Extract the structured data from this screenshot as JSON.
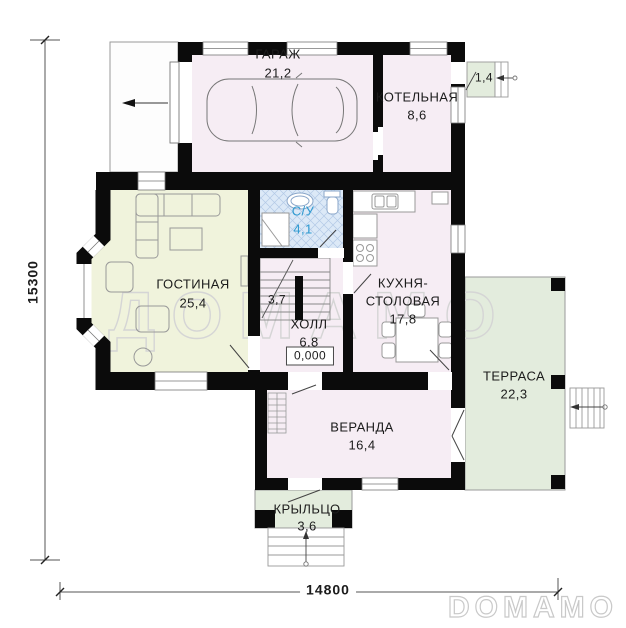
{
  "watermark": {
    "center_text": "ДОМАМО",
    "logo_text": "DOMAMO"
  },
  "dimensions": {
    "total_height_mm": "15300",
    "total_width_mm": "14800"
  },
  "rooms": {
    "garage": {
      "name": "ГАРАЖ",
      "area": "21,2"
    },
    "boiler": {
      "name": "КОТЕЛЬНАЯ",
      "area": "8,6"
    },
    "back_step": {
      "area": "1,4"
    },
    "bathroom": {
      "name": "С/У",
      "area": "4,1"
    },
    "living_room": {
      "name": "ГОСТИНАЯ",
      "area": "25,4"
    },
    "stairs": {
      "area": "3,7"
    },
    "hall": {
      "name": "ХОЛЛ",
      "area": "6,8",
      "floor_elevation": "0,000"
    },
    "kitchen": {
      "name_line1": "КУХНЯ-",
      "name_line2": "СТОЛОВАЯ",
      "area": "17,8"
    },
    "terrace": {
      "name": "ТЕРРАСА",
      "area": "22,3"
    },
    "veranda": {
      "name": "ВЕРАНДА",
      "area": "16,4"
    },
    "porch": {
      "name": "КРЫЛЬЦО",
      "area": "3,6"
    }
  },
  "colors": {
    "walls": "#0b0b0b",
    "floor_indoor": "#f6edf4",
    "floor_living": "#f0f3dc",
    "floor_outdoor": "#e3ecdd",
    "bathroom_tile": "#dce9f7",
    "bathroom_tile_line": "#b3c9e6",
    "bathroom_text": "#2e9ad1",
    "watermark_outline": "#d5d5d5",
    "logo_outline": "#c9c9c9"
  }
}
